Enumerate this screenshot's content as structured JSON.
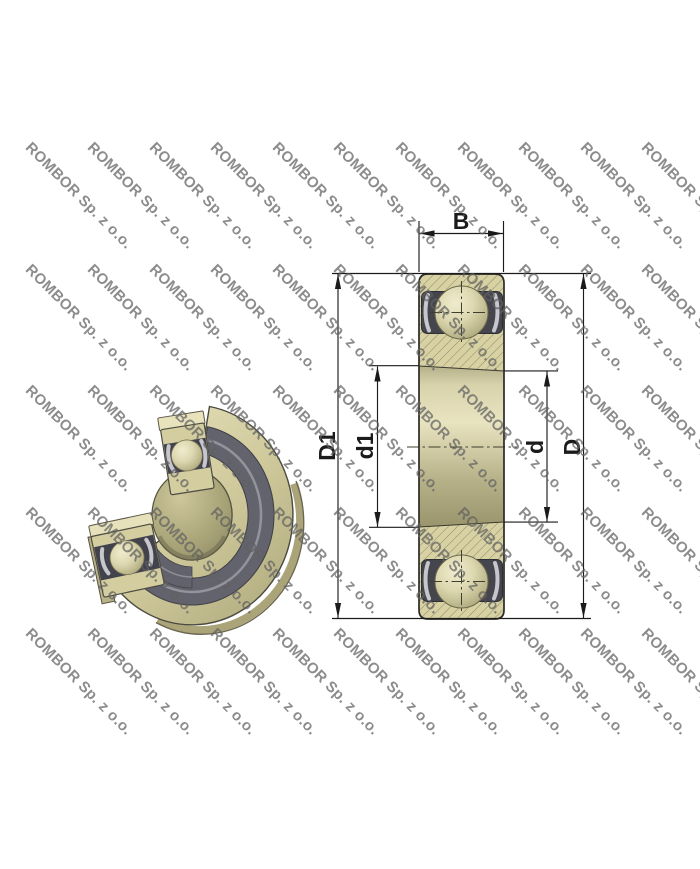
{
  "watermark": {
    "text": "ROMBOR Sp. z o.o."
  },
  "section_view": {
    "labels": {
      "B": "B",
      "D1": "D1",
      "d1": "d1",
      "d": "d",
      "D": "D"
    }
  },
  "theme": {
    "body_khaki": "#d7d1a4",
    "band_dark": "#45454e",
    "hatch_olive": "#8f8a60",
    "line": "#1b1b1b",
    "watermark_gray": "#616161"
  }
}
